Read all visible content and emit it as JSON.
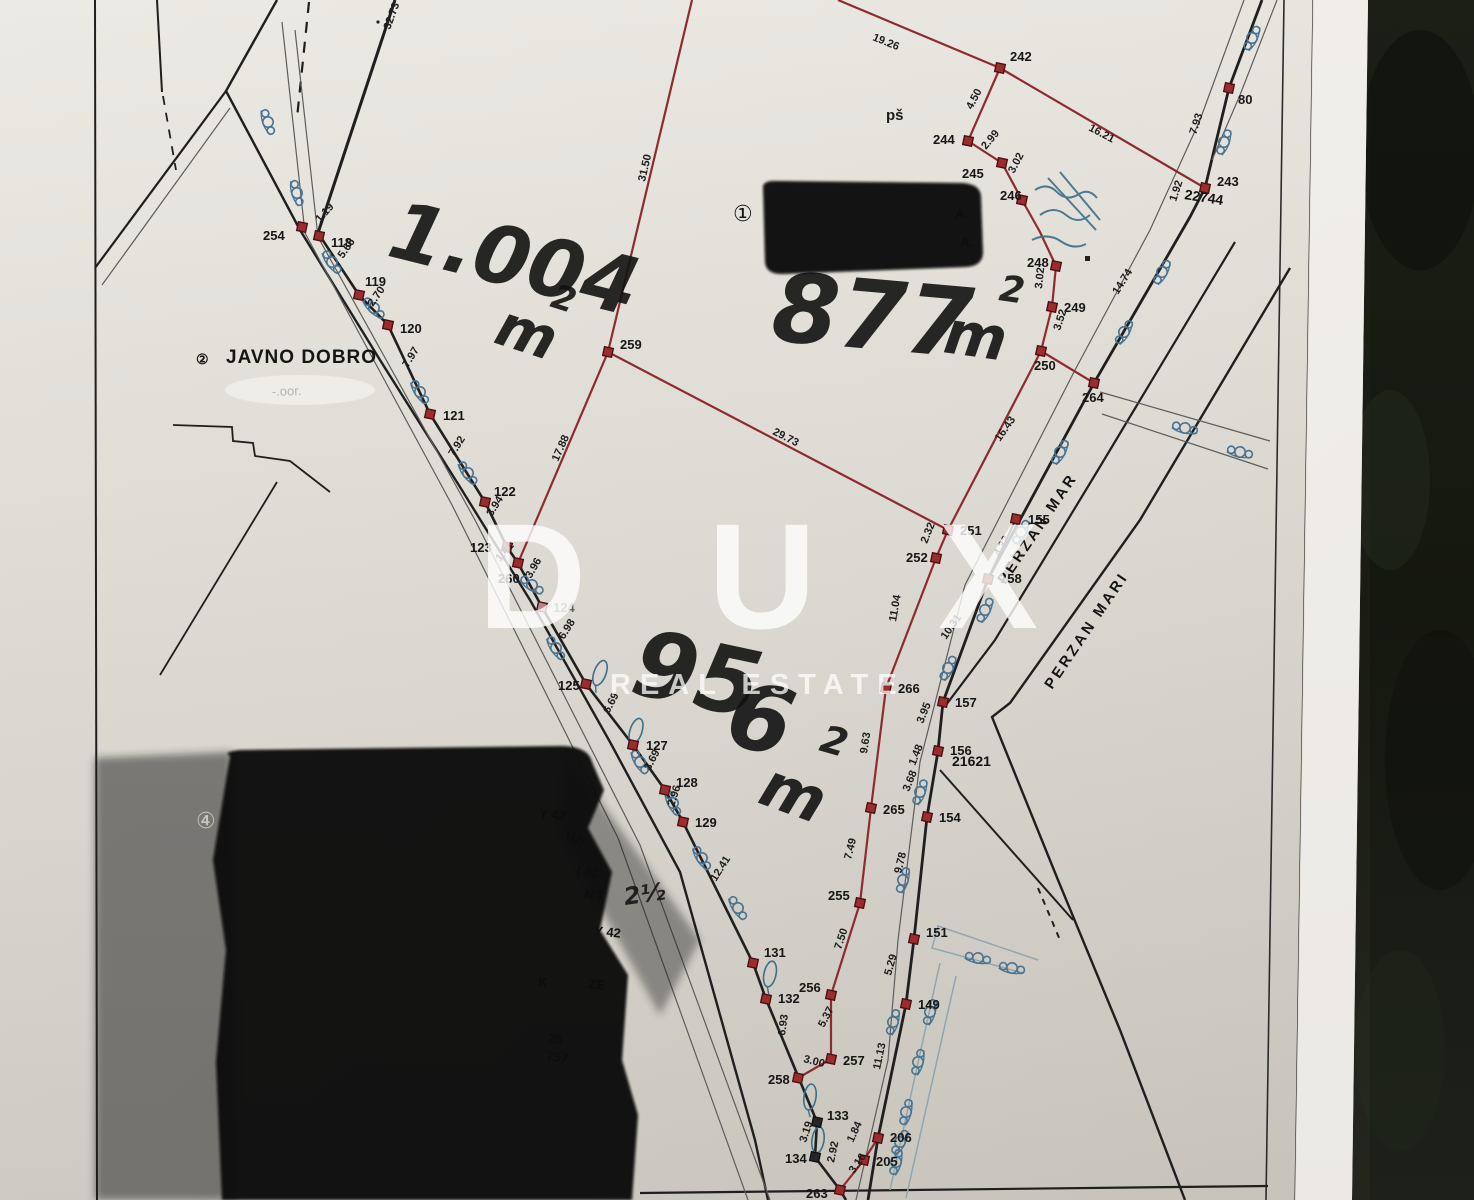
{
  "watermark": {
    "brand": "D U X",
    "subtitle": "REAL ESTATE",
    "color": "#ffffff"
  },
  "colors": {
    "paper": "#e9e6e0",
    "background": "#181b14",
    "new_boundary_red": "#8e2b2c",
    "old_boundary_black": "#1f1f1f",
    "vegetation_blue": "#4a7390"
  },
  "map": {
    "zone1": {
      "symbol": "①"
    },
    "zone2": {
      "symbol": "②",
      "label": "JAVNO DOBRO"
    },
    "zone4": {
      "symbol": "④"
    },
    "ps_label": "pš",
    "erased_text": "-.oor.",
    "redaction_note_fragments": [
      "A.",
      "A."
    ],
    "streets": [
      "PERZAN MAR",
      "PERZAN MARI"
    ],
    "parcel_numbers": [
      "22744",
      "21621"
    ],
    "areas_handwritten": [
      "1.004 m2",
      "877 m2",
      "956 m2"
    ],
    "hand": [
      {
        "t": "1.004",
        "x": 385,
        "y": 255,
        "r": 14,
        "s": 80
      },
      {
        "t": "m",
        "x": 492,
        "y": 342,
        "r": 18,
        "s": 58
      },
      {
        "t": "2",
        "x": 549,
        "y": 306,
        "r": 18,
        "s": 34
      },
      {
        "t": "877",
        "x": 770,
        "y": 340,
        "r": 5,
        "s": 96
      },
      {
        "t": "m",
        "x": 942,
        "y": 352,
        "r": 8,
        "s": 60
      },
      {
        "t": "2",
        "x": 998,
        "y": 300,
        "r": 8,
        "s": 36
      },
      {
        "t": "95",
        "x": 628,
        "y": 692,
        "r": 12,
        "s": 92
      },
      {
        "t": "6",
        "x": 722,
        "y": 742,
        "r": 14,
        "s": 92
      },
      {
        "t": "m",
        "x": 756,
        "y": 802,
        "r": 20,
        "s": 62
      },
      {
        "t": "2",
        "x": 818,
        "y": 750,
        "r": 16,
        "s": 38
      },
      {
        "t": "2½",
        "x": 625,
        "y": 905,
        "r": -8,
        "s": 24
      }
    ],
    "points": [
      {
        "n": "254",
        "x": 302,
        "y": 227,
        "lx": 263,
        "ly": 240
      },
      {
        "n": "118",
        "x": 319,
        "y": 236,
        "lx": 331,
        "ly": 247
      },
      {
        "n": "119",
        "x": 359,
        "y": 295,
        "lx": 365,
        "ly": 286
      },
      {
        "n": "120",
        "x": 388,
        "y": 325,
        "lx": 400,
        "ly": 333
      },
      {
        "n": "121",
        "x": 430,
        "y": 414,
        "lx": 443,
        "ly": 420
      },
      {
        "n": "122",
        "x": 485,
        "y": 502,
        "lx": 494,
        "ly": 496
      },
      {
        "n": "123",
        "x": 507,
        "y": 547,
        "lx": 470,
        "ly": 552
      },
      {
        "n": "260",
        "x": 518,
        "y": 563,
        "lx": 498,
        "ly": 583
      },
      {
        "n": "124",
        "x": 542,
        "y": 607,
        "lx": 553,
        "ly": 612,
        "faded": true
      },
      {
        "n": "125",
        "x": 586,
        "y": 684,
        "lx": 558,
        "ly": 690
      },
      {
        "n": "127",
        "x": 633,
        "y": 745,
        "lx": 646,
        "ly": 750
      },
      {
        "n": "128",
        "x": 665,
        "y": 790,
        "lx": 676,
        "ly": 787
      },
      {
        "n": "129",
        "x": 683,
        "y": 822,
        "lx": 695,
        "ly": 827
      },
      {
        "n": "131",
        "x": 753,
        "y": 963,
        "lx": 764,
        "ly": 957
      },
      {
        "n": "132",
        "x": 766,
        "y": 999,
        "lx": 778,
        "ly": 1003
      },
      {
        "n": "133",
        "x": 817,
        "y": 1122,
        "lx": 827,
        "ly": 1120,
        "dark": true
      },
      {
        "n": "134",
        "x": 815,
        "y": 1157,
        "lx": 785,
        "ly": 1163,
        "dark": true
      },
      {
        "n": "263",
        "x": 840,
        "y": 1190,
        "lx": 806,
        "ly": 1198
      },
      {
        "n": "258",
        "x": 798,
        "y": 1078,
        "lx": 768,
        "ly": 1084
      },
      {
        "n": "257",
        "x": 831,
        "y": 1059,
        "lx": 843,
        "ly": 1065
      },
      {
        "n": "256",
        "x": 831,
        "y": 995,
        "lx": 799,
        "ly": 992
      },
      {
        "n": "255",
        "x": 860,
        "y": 903,
        "lx": 828,
        "ly": 900
      },
      {
        "n": "265",
        "x": 871,
        "y": 808,
        "lx": 883,
        "ly": 814
      },
      {
        "n": "266",
        "x": 886,
        "y": 688,
        "lx": 898,
        "ly": 693
      },
      {
        "n": "252",
        "x": 936,
        "y": 558,
        "lx": 906,
        "ly": 562
      },
      {
        "n": "251",
        "x": 948,
        "y": 530,
        "lx": 960,
        "ly": 535
      },
      {
        "n": "259",
        "x": 608,
        "y": 352,
        "lx": 620,
        "ly": 349
      },
      {
        "n": "242",
        "x": 1000,
        "y": 68,
        "lx": 1010,
        "ly": 61
      },
      {
        "n": "244",
        "x": 968,
        "y": 141,
        "lx": 933,
        "ly": 144
      },
      {
        "n": "245",
        "x": 1002,
        "y": 163,
        "lx": 962,
        "ly": 178
      },
      {
        "n": "246",
        "x": 1022,
        "y": 200,
        "lx": 1000,
        "ly": 200
      },
      {
        "n": "248",
        "x": 1056,
        "y": 266,
        "lx": 1027,
        "ly": 267
      },
      {
        "n": "249",
        "x": 1052,
        "y": 307,
        "lx": 1064,
        "ly": 312
      },
      {
        "n": "250",
        "x": 1041,
        "y": 351,
        "lx": 1034,
        "ly": 370
      },
      {
        "n": "264",
        "x": 1094,
        "y": 383,
        "lx": 1082,
        "ly": 402
      },
      {
        "n": "243",
        "x": 1205,
        "y": 188,
        "lx": 1217,
        "ly": 186
      },
      {
        "n": "80",
        "x": 1229,
        "y": 88,
        "lx": 1238,
        "ly": 104
      },
      {
        "n": "155",
        "x": 1016,
        "y": 519,
        "lx": 1028,
        "ly": 524
      },
      {
        "n": "158",
        "x": 988,
        "y": 579,
        "lx": 1000,
        "ly": 583
      },
      {
        "n": "157",
        "x": 943,
        "y": 702,
        "lx": 955,
        "ly": 707
      },
      {
        "n": "156",
        "x": 938,
        "y": 751,
        "lx": 950,
        "ly": 755
      },
      {
        "n": "154",
        "x": 927,
        "y": 817,
        "lx": 939,
        "ly": 822
      },
      {
        "n": "151",
        "x": 914,
        "y": 939,
        "lx": 926,
        "ly": 937
      },
      {
        "n": "149",
        "x": 906,
        "y": 1004,
        "lx": 918,
        "ly": 1009
      },
      {
        "n": "206",
        "x": 878,
        "y": 1138,
        "lx": 890,
        "ly": 1142
      },
      {
        "n": "205",
        "x": 864,
        "y": 1160,
        "lx": 876,
        "ly": 1166
      }
    ],
    "measurements": [
      {
        "v": "32.73",
        "x": 390,
        "y": 30,
        "r": -70
      },
      {
        "v": "19.26",
        "x": 872,
        "y": 40,
        "r": 22
      },
      {
        "v": "31.50",
        "x": 645,
        "y": 182,
        "r": -77
      },
      {
        "v": "16.21",
        "x": 1088,
        "y": 130,
        "r": 28
      },
      {
        "v": "4.50",
        "x": 972,
        "y": 110,
        "r": -62
      },
      {
        "v": "2.99",
        "x": 986,
        "y": 150,
        "r": -50
      },
      {
        "v": "3.02",
        "x": 1014,
        "y": 174,
        "r": -62
      },
      {
        "v": "3.02",
        "x": 1042,
        "y": 289,
        "r": -84
      },
      {
        "v": "3.52",
        "x": 1060,
        "y": 331,
        "r": -72
      },
      {
        "v": "14.74",
        "x": 1118,
        "y": 295,
        "r": -58
      },
      {
        "v": "1.92",
        "x": 1176,
        "y": 202,
        "r": -72
      },
      {
        "v": "7.93",
        "x": 1196,
        "y": 135,
        "r": -72
      },
      {
        "v": "29.73",
        "x": 772,
        "y": 434,
        "r": 27
      },
      {
        "v": "16.43",
        "x": 1000,
        "y": 442,
        "r": -55
      },
      {
        "v": "17.88",
        "x": 558,
        "y": 462,
        "r": -66
      },
      {
        "v": "2.32",
        "x": 927,
        "y": 544,
        "r": -68
      },
      {
        "v": "4.32",
        "x": 1000,
        "y": 557,
        "r": -62
      },
      {
        "v": "10.31",
        "x": 946,
        "y": 640,
        "r": -55
      },
      {
        "v": "3.95",
        "x": 923,
        "y": 724,
        "r": -68
      },
      {
        "v": "1.48",
        "x": 915,
        "y": 766,
        "r": -68
      },
      {
        "v": "3.68",
        "x": 909,
        "y": 792,
        "r": -68
      },
      {
        "v": "9.78",
        "x": 901,
        "y": 874,
        "r": -76
      },
      {
        "v": "5.29",
        "x": 891,
        "y": 976,
        "r": -74
      },
      {
        "v": "11.13",
        "x": 880,
        "y": 1070,
        "r": -78
      },
      {
        "v": "11.04",
        "x": 896,
        "y": 622,
        "r": -80
      },
      {
        "v": "9.63",
        "x": 867,
        "y": 754,
        "r": -81
      },
      {
        "v": "7.49",
        "x": 851,
        "y": 860,
        "r": -76
      },
      {
        "v": "7.50",
        "x": 841,
        "y": 950,
        "r": -72
      },
      {
        "v": "5.37",
        "x": 824,
        "y": 1028,
        "r": -62
      },
      {
        "v": "3.00",
        "x": 803,
        "y": 1062,
        "r": 14
      },
      {
        "v": "6.93",
        "x": 785,
        "y": 1036,
        "r": -82
      },
      {
        "v": "12.41",
        "x": 716,
        "y": 882,
        "r": -58
      },
      {
        "v": "2.96",
        "x": 674,
        "y": 807,
        "r": -72
      },
      {
        "v": "3.69",
        "x": 650,
        "y": 771,
        "r": -62
      },
      {
        "v": "6.69",
        "x": 609,
        "y": 714,
        "r": -62
      },
      {
        "v": "6.98",
        "x": 564,
        "y": 640,
        "r": -58
      },
      {
        "v": "3.96",
        "x": 531,
        "y": 579,
        "r": -60
      },
      {
        "v": "1.41",
        "x": 500,
        "y": 562,
        "r": -48
      },
      {
        "v": "3.94",
        "x": 492,
        "y": 517,
        "r": -58
      },
      {
        "v": "7.92",
        "x": 454,
        "y": 457,
        "r": -58
      },
      {
        "v": "7.97",
        "x": 408,
        "y": 368,
        "r": -58
      },
      {
        "v": "2.70",
        "x": 373,
        "y": 307,
        "r": -55
      },
      {
        "v": "5.66",
        "x": 343,
        "y": 259,
        "r": -55
      },
      {
        "v": "1.19",
        "x": 320,
        "y": 223,
        "r": -48
      },
      {
        "v": "3.19",
        "x": 806,
        "y": 1143,
        "r": -72
      },
      {
        "v": "2.92",
        "x": 834,
        "y": 1163,
        "r": -78
      },
      {
        "v": "3.16",
        "x": 854,
        "y": 1174,
        "r": -55
      },
      {
        "v": "1.84",
        "x": 853,
        "y": 1143,
        "r": -65
      }
    ],
    "fragments": [
      {
        "t": "Y 42",
        "x": 539,
        "y": 818,
        "r": 4
      },
      {
        "t": "NA",
        "x": 566,
        "y": 841,
        "r": 4
      },
      {
        "t": "( 42",
        "x": 576,
        "y": 875,
        "r": 6
      },
      {
        "t": "N'1",
        "x": 584,
        "y": 898,
        "r": 6
      },
      {
        "t": "Y 42",
        "x": 594,
        "y": 935,
        "r": 6
      },
      {
        "t": "K",
        "x": 538,
        "y": 986,
        "r": 6
      },
      {
        "t": "ZE",
        "x": 588,
        "y": 988,
        "r": 6
      },
      {
        "t": "26",
        "x": 548,
        "y": 1042,
        "r": 8
      },
      {
        "t": "757",
        "x": 546,
        "y": 1060,
        "r": 8
      },
      {
        "t": "A.",
        "x": 955,
        "y": 218,
        "r": 2
      },
      {
        "t": "A.",
        "x": 960,
        "y": 246,
        "r": 2
      }
    ],
    "hedges": [
      {
        "x": 332,
        "y": 262,
        "r": 55
      },
      {
        "x": 374,
        "y": 308,
        "r": 45
      },
      {
        "x": 420,
        "y": 392,
        "r": 58
      },
      {
        "x": 468,
        "y": 473,
        "r": 55
      },
      {
        "x": 532,
        "y": 585,
        "r": 35
      },
      {
        "x": 556,
        "y": 648,
        "r": 58
      },
      {
        "x": 640,
        "y": 762,
        "r": 60
      },
      {
        "x": 673,
        "y": 803,
        "r": 65
      },
      {
        "x": 702,
        "y": 858,
        "r": 58
      },
      {
        "x": 738,
        "y": 908,
        "r": 58
      },
      {
        "x": 268,
        "y": 122,
        "r": 72
      },
      {
        "x": 297,
        "y": 193,
        "r": 75
      },
      {
        "x": 1252,
        "y": 38,
        "r": -62
      },
      {
        "x": 1224,
        "y": 142,
        "r": -68
      },
      {
        "x": 1162,
        "y": 272,
        "r": -60
      },
      {
        "x": 1124,
        "y": 332,
        "r": -58
      },
      {
        "x": 1060,
        "y": 452,
        "r": -60
      },
      {
        "x": 1021,
        "y": 532,
        "r": -60
      },
      {
        "x": 985,
        "y": 610,
        "r": -62
      },
      {
        "x": 948,
        "y": 668,
        "r": -62
      },
      {
        "x": 920,
        "y": 792,
        "r": -68
      },
      {
        "x": 903,
        "y": 880,
        "r": -72
      },
      {
        "x": 893,
        "y": 1022,
        "r": -72
      },
      {
        "x": 900,
        "y": 1142,
        "r": -60
      },
      {
        "x": 1185,
        "y": 428,
        "r": 14
      },
      {
        "x": 1240,
        "y": 452,
        "r": 14
      },
      {
        "x": 978,
        "y": 958,
        "r": 12
      },
      {
        "x": 1012,
        "y": 968,
        "r": 12
      },
      {
        "x": 930,
        "y": 1012,
        "r": -72
      },
      {
        "x": 918,
        "y": 1062,
        "r": -74
      },
      {
        "x": 906,
        "y": 1112,
        "r": -74
      },
      {
        "x": 896,
        "y": 1162,
        "r": -74
      }
    ],
    "trees": [
      {
        "x": 600,
        "y": 673,
        "r": 20
      },
      {
        "x": 636,
        "y": 731,
        "r": 18
      },
      {
        "x": 770,
        "y": 974,
        "r": 12
      },
      {
        "x": 810,
        "y": 1097,
        "r": 8
      },
      {
        "x": 818,
        "y": 1140,
        "r": 8
      }
    ]
  }
}
